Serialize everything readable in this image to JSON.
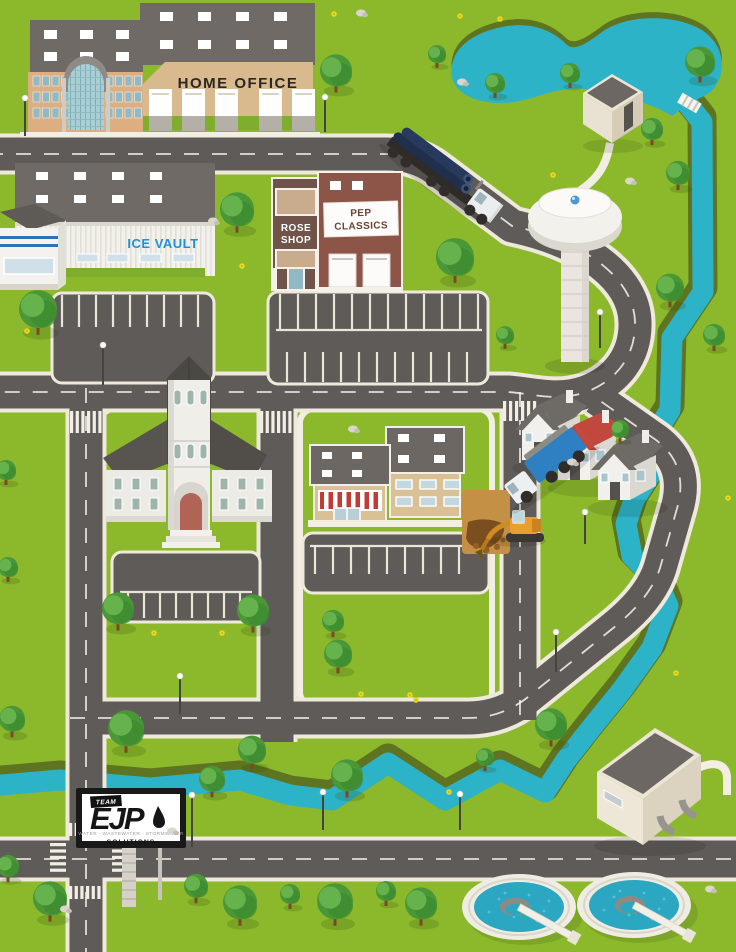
{
  "scene": {
    "title": "Team EJP illustrated town map",
    "description": "Isometric illustration of a town with water infrastructure: home office, ice vault, shops, church, houses, water tower, pond, river, construction site and wastewater treatment plant"
  },
  "signs": {
    "home_office": "HOME OFFICE",
    "ice_vault": "ICE VAULT",
    "rose_line1": "ROSE",
    "rose_line2": "SHOP",
    "pep_line1": "PEP",
    "pep_line2": "CLASSICS"
  },
  "billboard": {
    "team": "TEAM",
    "ejp": "EJP",
    "tagline": "WATER - WASTEWATER - STORMWATER",
    "solutions": "SOLUTIONS"
  },
  "colors": {
    "grass": "#8cb82c",
    "road": "#5f5b58",
    "curb": "#efe9dc",
    "water": "#2db3c7",
    "bank": "#5e7420",
    "white": "#f2eee4",
    "ice_vault_blue": "#2191d6",
    "awning_red": "#c23b35",
    "house_roof_red": "#c2473c",
    "pipe_navy": "#202f4c",
    "truck_blue": "#2f80c2",
    "excavator_orange": "#e89f2b",
    "billboard_black": "#161616"
  }
}
